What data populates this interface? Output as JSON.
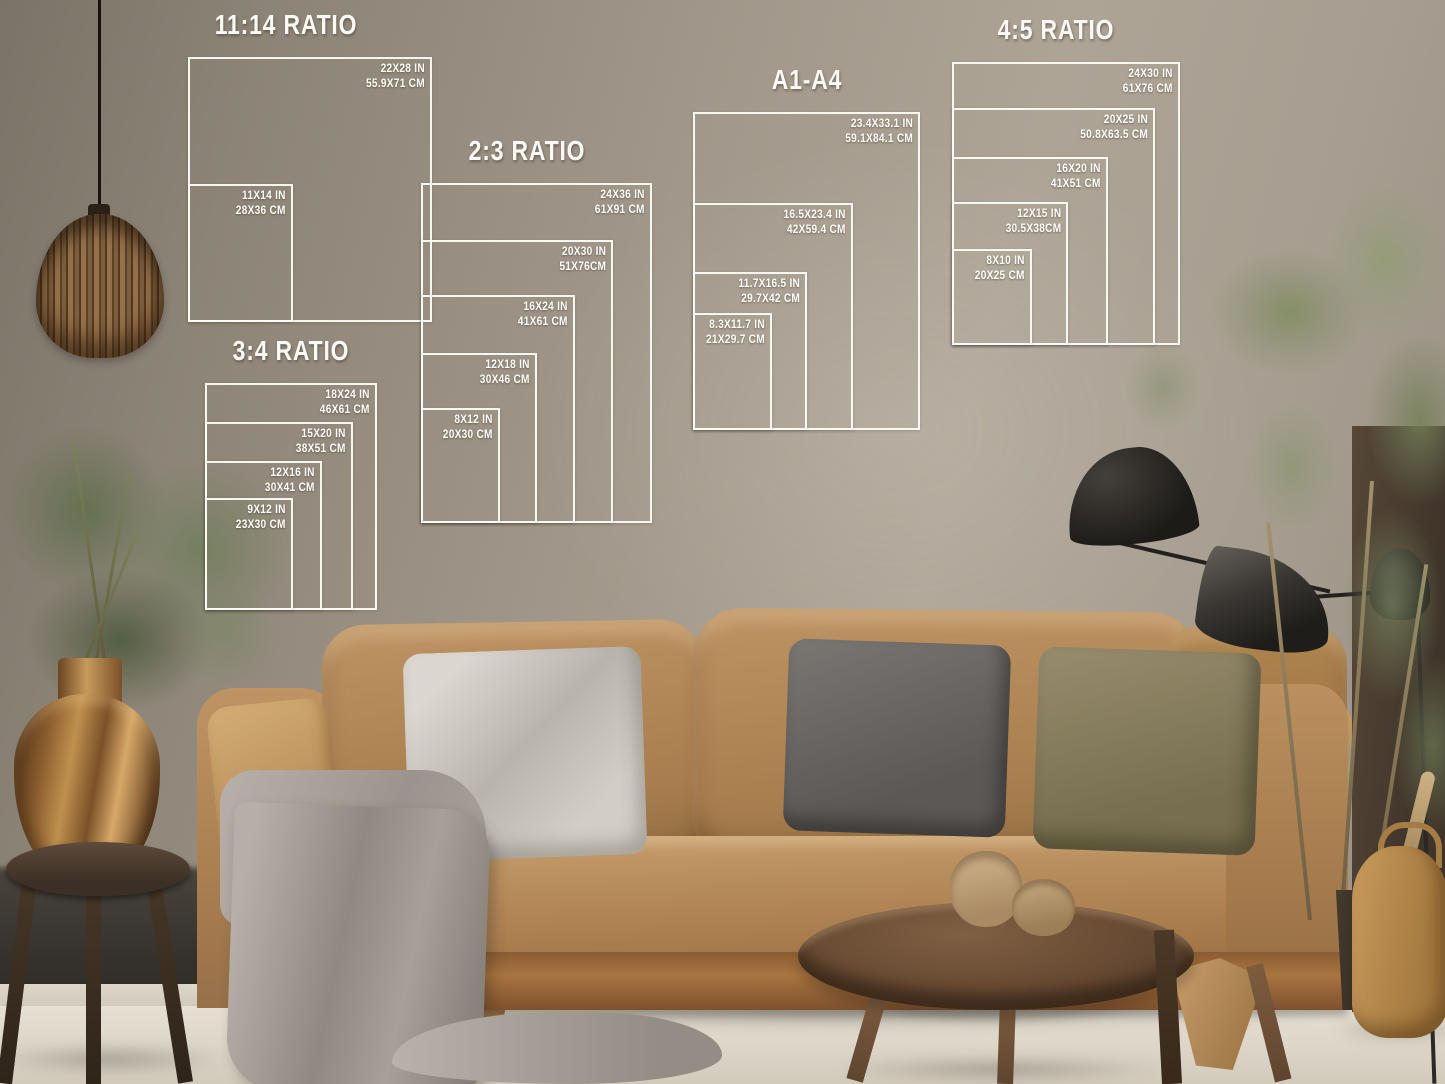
{
  "size_charts": [
    {
      "title": "11:14 RATIO",
      "sizes": [
        {
          "in": "22X28 IN",
          "cm": "55.9X71 CM"
        },
        {
          "in": "11X14 IN",
          "cm": "28X36 CM"
        }
      ]
    },
    {
      "title": "2:3 RATIO",
      "sizes": [
        {
          "in": "24X36 IN",
          "cm": "61X91 CM"
        },
        {
          "in": "20X30 IN",
          "cm": "51X76CM"
        },
        {
          "in": "16X24 IN",
          "cm": "41X61 CM"
        },
        {
          "in": "12X18 IN",
          "cm": "30X46 CM"
        },
        {
          "in": "8X12 IN",
          "cm": "20X30 CM"
        }
      ]
    },
    {
      "title": "3:4 RATIO",
      "sizes": [
        {
          "in": "18X24 IN",
          "cm": "46X61 CM"
        },
        {
          "in": "15X20 IN",
          "cm": "38X51 CM"
        },
        {
          "in": "12X16 IN",
          "cm": "30X41 CM"
        },
        {
          "in": "9X12 IN",
          "cm": "23X30 CM"
        }
      ]
    },
    {
      "title": "A1-A4",
      "sizes": [
        {
          "in": "23.4X33.1 IN",
          "cm": "59.1X84.1 CM"
        },
        {
          "in": "16.5X23.4 IN",
          "cm": "42X59.4 CM"
        },
        {
          "in": "11.7X16.5 IN",
          "cm": "29.7X42 CM"
        },
        {
          "in": "8.3X11.7 IN",
          "cm": "21X29.7 CM"
        }
      ]
    },
    {
      "title": "4:5 RATIO",
      "sizes": [
        {
          "in": "24X30 IN",
          "cm": "61X76 CM"
        },
        {
          "in": "20X25 IN",
          "cm": "50.8X63.5 CM"
        },
        {
          "in": "16X20 IN",
          "cm": "41X51 CM"
        },
        {
          "in": "12X15 IN",
          "cm": "30.5X38CM"
        },
        {
          "in": "8X10 IN",
          "cm": "20X25 CM"
        }
      ]
    }
  ],
  "scene": {
    "objects": [
      "taupe-wall",
      "light-wood-floor",
      "rattan-pendant-lamp",
      "eucalyptus-in-brass-vase",
      "dark-wood-stool",
      "tan-velvet-sofa",
      "gray-textured-pillow",
      "charcoal-pillow",
      "olive-pillow",
      "tan-pillows",
      "gray-throw-blanket",
      "round-wood-coffee-table",
      "two-clay-pots",
      "black-sculptural-floor-lamp",
      "tall-green-plant",
      "woven-basket"
    ],
    "colors": {
      "overlay_line": "#fcfaf6",
      "overlay_text": "#fdfcf9",
      "wall": "#a1978a",
      "wall_dark": "#7b7367",
      "floor": "#e0dacd",
      "sofa": "#b0855a",
      "sofa_wood_base": "#9a6a3c",
      "pillow_gray": "#c9c4bd",
      "pillow_charcoal": "#6b6764",
      "pillow_olive": "#8c8166",
      "blanket_gray": "#9d978f",
      "table_wood": "#64492f",
      "brass_vase": "#b0823f",
      "plant_green": "#75815c",
      "lamp_black": "#25221f",
      "basket_tan": "#b98e55"
    }
  }
}
